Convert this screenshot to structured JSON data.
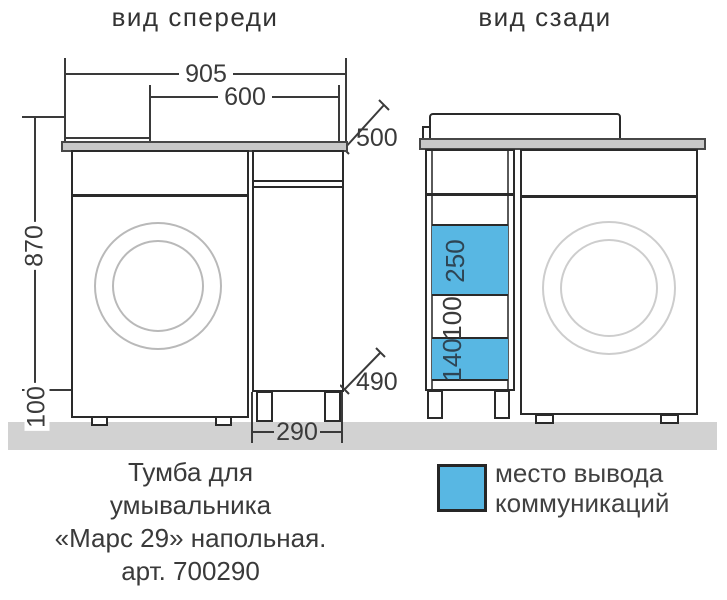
{
  "drawing": {
    "product": "Тумба для умывальника «Марс 29» напольная",
    "article": "700290"
  },
  "front_view": {
    "title": "вид спереди",
    "dim_total_width": "905",
    "dim_wm_width": "600",
    "dim_depth": "500",
    "dim_height": "870",
    "dim_legs": "100",
    "dim_cabinet_width": "290",
    "dim_cabinet_depth": "490"
  },
  "back_view": {
    "title": "вид сзади",
    "cutouts": [
      {
        "label": "250",
        "fill": "blue"
      },
      {
        "label": "100",
        "fill": "white"
      },
      {
        "label": "140",
        "fill": "blue"
      }
    ]
  },
  "legend": {
    "swatch_color": "#58b7e3",
    "text_line1": "место вывода",
    "text_line2": "коммуникаций"
  },
  "caption": {
    "line1": "Тумба для",
    "line2": "умывальника",
    "line3": "«Марс 29» напольная.",
    "line4": "арт. 700290"
  },
  "colors": {
    "cutout_blue": "#58b7e3",
    "outline_dark": "#2a2a2a",
    "counter_gray": "#c8c8c8",
    "floor_gray": "#d2d2d2"
  }
}
